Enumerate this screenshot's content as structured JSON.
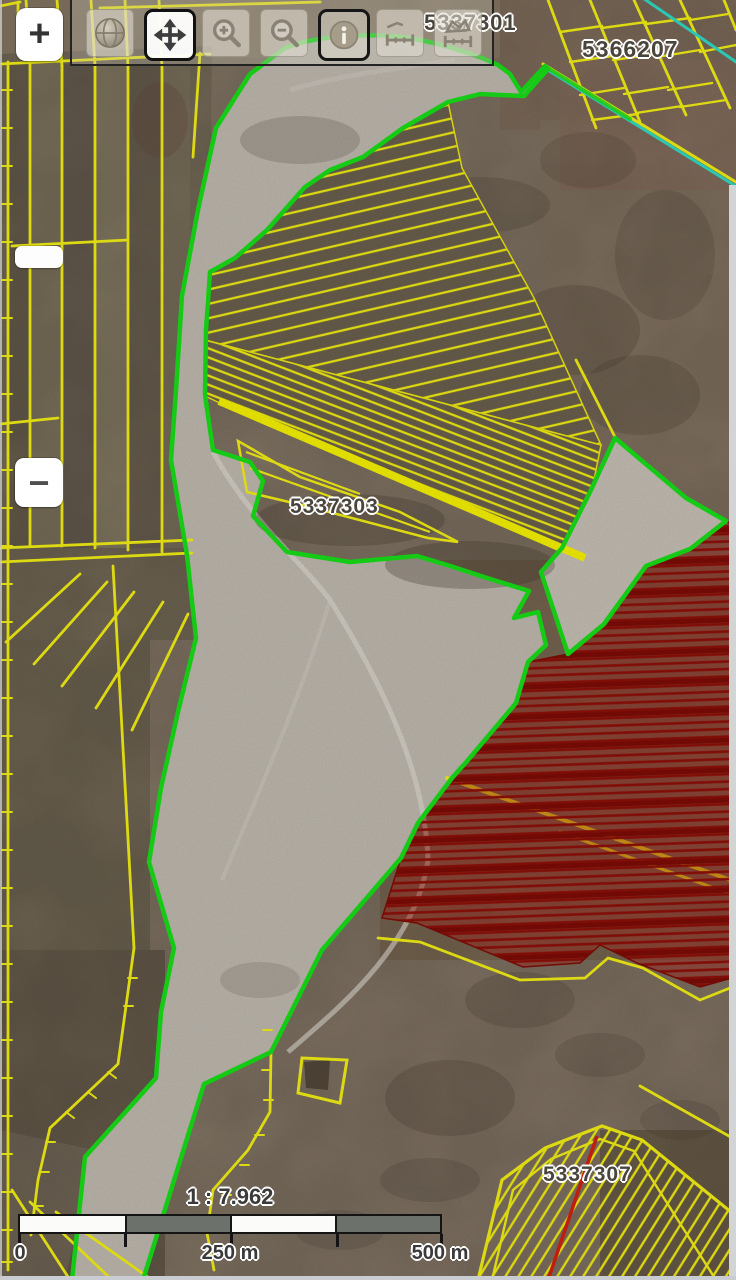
{
  "parcel_labels": {
    "p1": "5337301",
    "p2": "5366207",
    "p3": "5337303",
    "p4": "5337307"
  },
  "controls": {
    "zoom_in": "+",
    "zoom_out": "−",
    "active_tool": "pan",
    "toolbar_icons": [
      "globe-icon",
      "pan-icon",
      "zoom-in-icon",
      "zoom-out-icon",
      "info-icon",
      "measure-distance-icon",
      "measure-area-icon"
    ]
  },
  "scale_bar": {
    "ratio": "1 : 7.962",
    "tick_labels": [
      "0",
      "250 m",
      "500 m"
    ]
  },
  "colors": {
    "parcel_line": "#f0ec14",
    "selection_outline": "#17dc17",
    "hatch_red": "#8c0f08",
    "teal_line": "#2ed9c3"
  }
}
